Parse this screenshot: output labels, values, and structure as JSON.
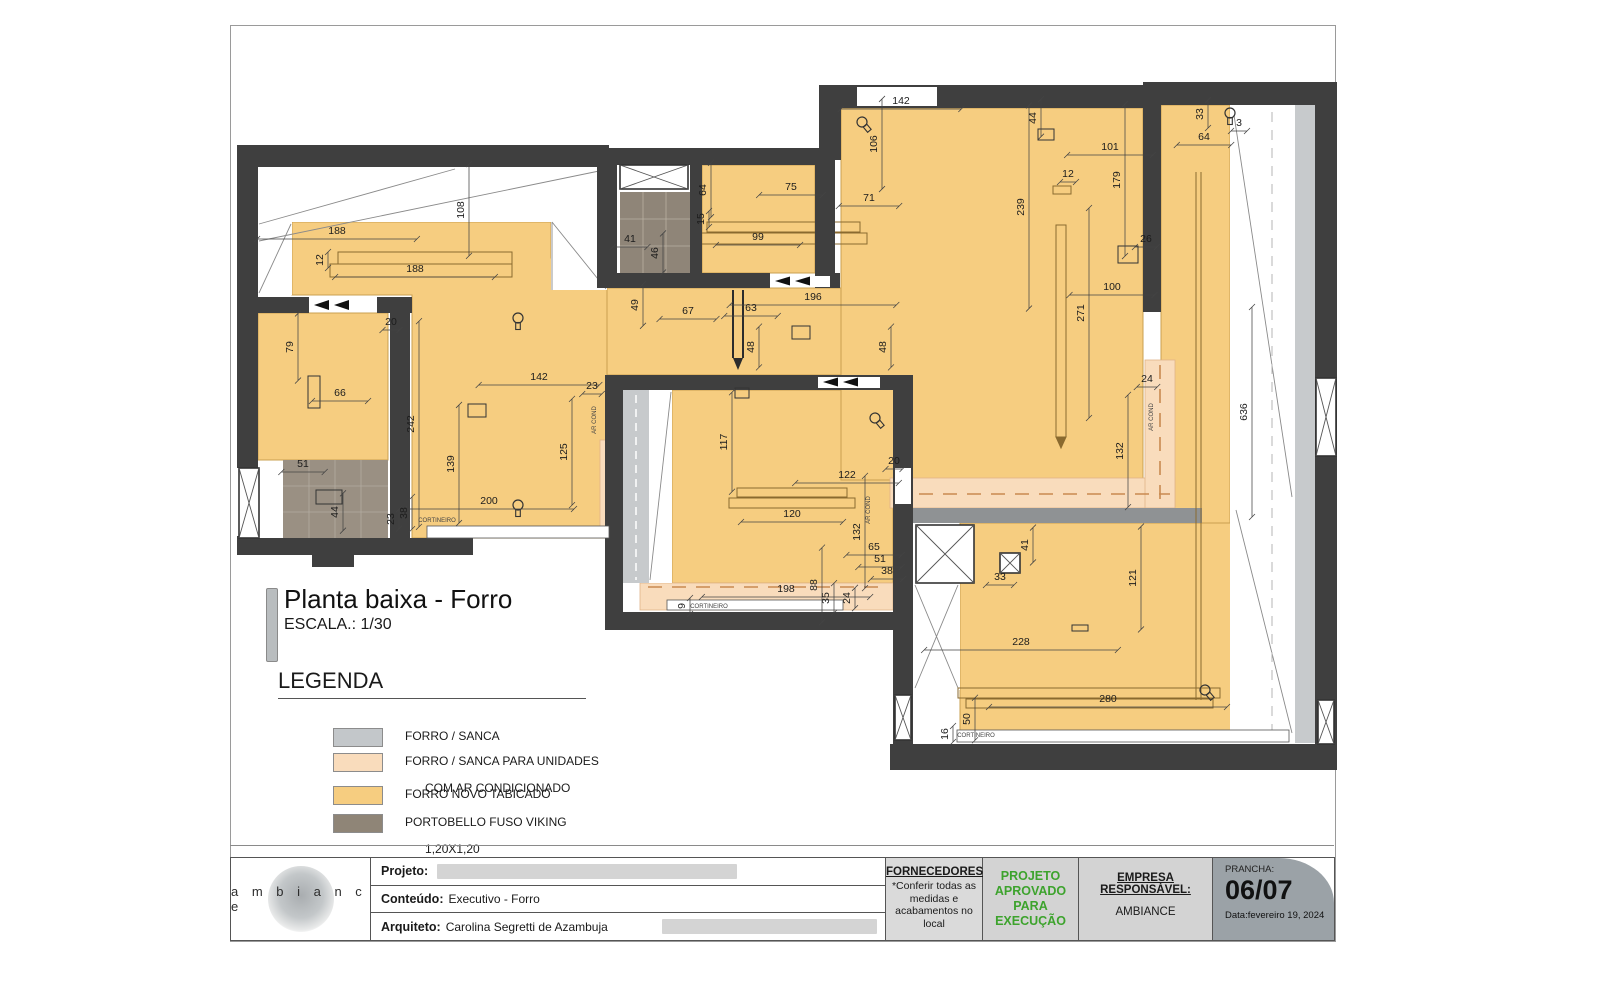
{
  "sheet": {
    "title": "Planta baixa - Forro",
    "scale": "ESCALA.: 1/30"
  },
  "legend": {
    "title": "LEGENDA",
    "items": [
      {
        "l1": "FORRO / SANCA",
        "l2": "",
        "color": "#c3c7ca"
      },
      {
        "l1": "FORRO / SANCA PARA UNIDADES",
        "l2": "COM AR CONDICIONADO",
        "color": "#f9dcbc"
      },
      {
        "l1": "FORRO NOVO TABICADO",
        "l2": "",
        "color": "#f6cd80"
      },
      {
        "l1": "PORTOBELLO FUSO VIKING",
        "l2": "1,20X1,20",
        "color": "#8f8577"
      }
    ]
  },
  "titleblock": {
    "logo": "a m b i a n c e",
    "projeto_label": "Projeto:",
    "conteudo_label": "Conteúdo:",
    "conteudo_value": "Executivo - Forro",
    "arquiteto_label": "Arquiteto:",
    "arquiteto_value": "Carolina Segretti de Azambuja",
    "fornecedores_label": "FORNECEDORES:",
    "fornecedores_note": "*Conferir todas as medidas e acabamentos no local",
    "approval": "PROJETO APROVADO PARA EXECUÇÃO",
    "approval_color": "#3da32d",
    "empresa_label": "EMPRESA RESPONSÁVEL:",
    "empresa_value": "AMBIANCE",
    "prancha_label": "PRANCHA:",
    "prancha_value": "06/07",
    "data_value": "Data:fevereiro 19, 2024"
  },
  "plan": {
    "labels": [
      [
        337,
        234,
        "188",
        0
      ],
      [
        323,
        260,
        "12",
        1
      ],
      [
        415,
        272,
        "188",
        0
      ],
      [
        464,
        210,
        "108",
        1
      ],
      [
        293,
        347,
        "79",
        1
      ],
      [
        340,
        396,
        "66",
        0
      ],
      [
        303,
        467,
        "51",
        0
      ],
      [
        338,
        512,
        "44",
        1
      ],
      [
        391,
        325,
        "20",
        0
      ],
      [
        414,
        424,
        "242",
        1
      ],
      [
        454,
        464,
        "139",
        1
      ],
      [
        539,
        380,
        "142",
        0
      ],
      [
        592,
        389,
        "23",
        0
      ],
      [
        567,
        452,
        "125",
        1
      ],
      [
        489,
        504,
        "200",
        0
      ],
      [
        394,
        519,
        "23",
        1
      ],
      [
        407,
        513,
        "38",
        1
      ],
      [
        437,
        522,
        "CORTINEIRO",
        0,
        1
      ],
      [
        596,
        420,
        "AR COND",
        1,
        1
      ],
      [
        706,
        190,
        "64",
        1
      ],
      [
        791,
        190,
        "75",
        0
      ],
      [
        704,
        219,
        "15",
        1
      ],
      [
        758,
        240,
        "99",
        0
      ],
      [
        630,
        242,
        "41",
        0
      ],
      [
        658,
        253,
        "46",
        1
      ],
      [
        638,
        305,
        "49",
        1
      ],
      [
        688,
        314,
        "67",
        0
      ],
      [
        751,
        311,
        "63",
        0
      ],
      [
        813,
        300,
        "196",
        0
      ],
      [
        754,
        347,
        "48",
        1
      ],
      [
        886,
        347,
        "48",
        1
      ],
      [
        901,
        104,
        "142",
        0
      ],
      [
        877,
        144,
        "106",
        1
      ],
      [
        869,
        201,
        "71",
        0
      ],
      [
        1036,
        118,
        "44",
        1
      ],
      [
        1110,
        150,
        "101",
        0
      ],
      [
        1068,
        177,
        "12",
        0
      ],
      [
        1024,
        207,
        "239",
        1
      ],
      [
        1120,
        180,
        "179",
        1
      ],
      [
        1146,
        242,
        "26",
        0
      ],
      [
        1112,
        290,
        "100",
        0
      ],
      [
        1084,
        313,
        "271",
        1
      ],
      [
        1203,
        114,
        "33",
        1
      ],
      [
        1239,
        126,
        "3",
        0
      ],
      [
        1204,
        140,
        "64",
        0
      ],
      [
        1147,
        382,
        "24",
        0
      ],
      [
        1123,
        451,
        "132",
        1
      ],
      [
        1247,
        412,
        "636",
        1
      ],
      [
        1153,
        417,
        "AR COND",
        1,
        1
      ],
      [
        727,
        442,
        "117",
        1
      ],
      [
        847,
        478,
        "122",
        0
      ],
      [
        792,
        517,
        "120",
        0
      ],
      [
        894,
        464,
        "20",
        0
      ],
      [
        860,
        532,
        "132",
        1
      ],
      [
        874,
        550,
        "65",
        0
      ],
      [
        880,
        562,
        "51",
        0
      ],
      [
        887,
        574,
        "38",
        0
      ],
      [
        817,
        585,
        "88",
        1
      ],
      [
        786,
        592,
        "198",
        0
      ],
      [
        829,
        598,
        "35",
        1
      ],
      [
        850,
        598,
        "24",
        1
      ],
      [
        685,
        606,
        "9",
        1
      ],
      [
        709,
        608,
        "CORTINEIRO",
        0,
        1
      ],
      [
        870,
        510,
        "AR COND",
        1,
        1
      ],
      [
        1028,
        545,
        "41",
        1
      ],
      [
        1000,
        580,
        "33",
        0
      ],
      [
        1136,
        578,
        "121",
        1
      ],
      [
        1021,
        645,
        "228",
        0
      ],
      [
        1108,
        702,
        "280",
        0
      ],
      [
        970,
        719,
        "50",
        1
      ],
      [
        948,
        734,
        "16",
        1
      ],
      [
        976,
        737,
        "CORTINEIRO",
        0,
        1
      ]
    ],
    "light_symbols": [
      [
        518,
        318,
        0
      ],
      [
        518,
        505,
        0
      ],
      [
        862,
        122,
        -40
      ],
      [
        875,
        418,
        -40
      ],
      [
        1230,
        113,
        0
      ],
      [
        1205,
        690,
        -40
      ]
    ],
    "window_x_symbols": [
      [
        239,
        468,
        20,
        70
      ],
      [
        620,
        165,
        68,
        24
      ],
      [
        916,
        525,
        58,
        58
      ],
      [
        1000,
        553,
        20,
        20
      ],
      [
        1316,
        378,
        20,
        78
      ],
      [
        1318,
        700,
        16,
        44
      ],
      [
        895,
        695,
        16,
        45
      ]
    ],
    "fixture_boxes": [
      [
        468,
        404,
        18,
        13
      ],
      [
        792,
        326,
        18,
        13
      ],
      [
        1038,
        129,
        16,
        11
      ],
      [
        1118,
        246,
        20,
        17
      ],
      [
        316,
        490,
        26,
        14
      ],
      [
        308,
        376,
        12,
        32
      ],
      [
        1072,
        625,
        16,
        6
      ],
      [
        735,
        388,
        14,
        10
      ]
    ]
  }
}
